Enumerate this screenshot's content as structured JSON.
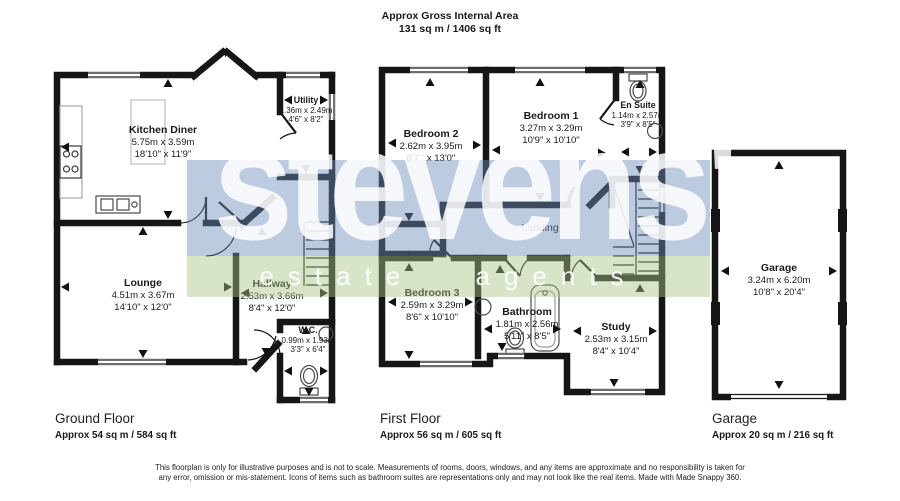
{
  "header": {
    "title": "Approx Gross Internal Area",
    "area": "131 sq m / 1406 sq ft"
  },
  "watermark": {
    "name": "stevens'",
    "tagline": "estate agents",
    "blue": "rgba(107,140,184,0.45)",
    "green": "rgba(169,196,133,0.45)"
  },
  "rooms": {
    "kitchen": {
      "name": "Kitchen Diner",
      "metric": "5.75m x 3.59m",
      "imperial": "18'10\" x 11'9\""
    },
    "utility": {
      "name": "Utility",
      "metric": "1.36m x 2.49m",
      "imperial": "4'6\" x 8'2\""
    },
    "lounge": {
      "name": "Lounge",
      "metric": "4.51m x 3.67m",
      "imperial": "14'10\" x 12'0\""
    },
    "hallway": {
      "name": "Hallway",
      "metric": "2.53m x 3.66m",
      "imperial": "8'4\" x 12'0\""
    },
    "wc": {
      "name": "W.C.",
      "metric": "0.99m x 1.93m",
      "imperial": "3'3\" x 6'4\""
    },
    "bedroom2": {
      "name": "Bedroom 2",
      "metric": "2.62m x 3.95m",
      "imperial": "8'7\"' x 13'0\""
    },
    "bedroom1": {
      "name": "Bedroom 1",
      "metric": "3.27m x 3.29m",
      "imperial": "10'9\" x 10'10\""
    },
    "ensuite": {
      "name": "En Suite",
      "metric": "1.14m x 2.57m",
      "imperial": "3'9\" x 8'5\""
    },
    "landing": {
      "name": "Landing"
    },
    "bedroom3": {
      "name": "Bedroom 3",
      "metric": "2.59m x 3.29m",
      "imperial": "8'6\" x 10'10\""
    },
    "bathroom": {
      "name": "Bathroom",
      "metric": "1.81m x 2.56m",
      "imperial": "5'11\" x 8'5\""
    },
    "study": {
      "name": "Study",
      "metric": "2.53m x 3.15m",
      "imperial": "8'4\" x 10'4\""
    },
    "garage": {
      "name": "Garage",
      "metric": "3.24m x 6.20m",
      "imperial": "10'8\" x 20'4\""
    }
  },
  "floors": [
    {
      "label": "Ground Floor",
      "area": "Approx 54 sq m / 584 sq ft"
    },
    {
      "label": "First Floor",
      "area": "Approx 56 sq m / 605 sq ft"
    },
    {
      "label": "Garage",
      "area": "Approx 20 sq m / 216 sq ft"
    }
  ],
  "footer": {
    "disclaimer": "This floorplan is only for illustrative purposes and is not to scale. Measurements of rooms, doors, windows, and any items are approximate and no responsibility is taken for any error, omission or mis-statement. Icons of items such as bathroom suites are representations only and may not look like the real items. Made with Made Snappy 360."
  }
}
